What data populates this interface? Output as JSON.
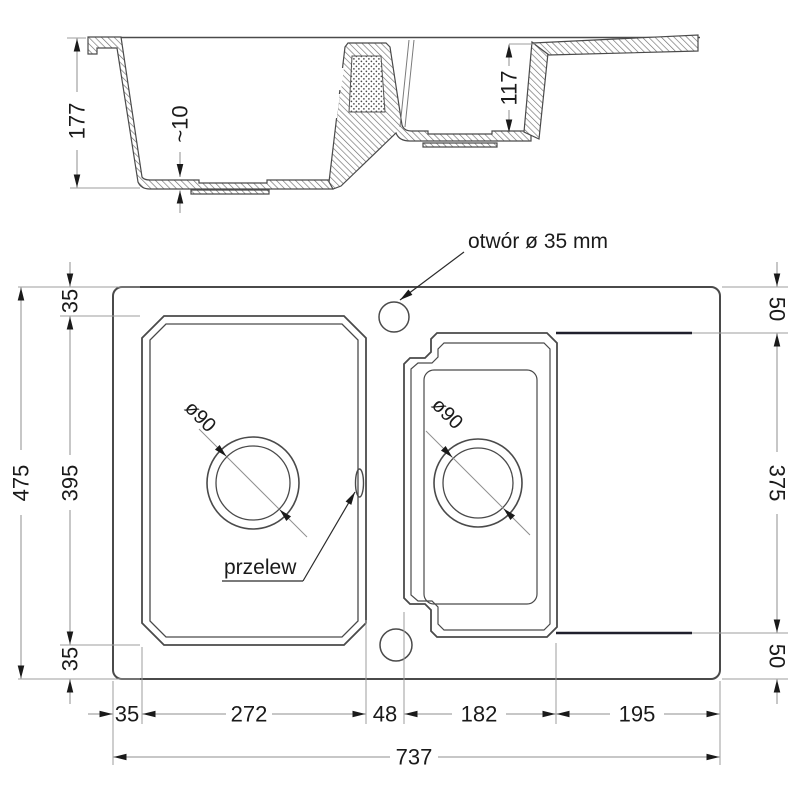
{
  "section": {
    "depth_main_bowl": "177",
    "bottom_thickness": "~10",
    "depth_small_bowl": "117"
  },
  "plan": {
    "faucet_hole_label": "otwór ø 35 mm",
    "overflow_label": "przelew",
    "main_drain_diameter": "ø90",
    "small_drain_diameter": "ø90",
    "width": {
      "left_margin": "35",
      "main_bowl": "272",
      "divider": "48",
      "small_bowl": "182",
      "drainboard": "195",
      "total": "737"
    },
    "height_left": {
      "total": "475",
      "top_margin": "35",
      "main_bowl": "395",
      "bottom_margin": "35"
    },
    "height_right": {
      "top_margin": "50",
      "small_bowl_zone": "375",
      "bottom_margin": "50"
    }
  },
  "colors": {
    "outline": "#4a4a4a",
    "dimension": "#8f8f8f",
    "dark_edge": "#20202c",
    "text": "#1a1a1a"
  }
}
